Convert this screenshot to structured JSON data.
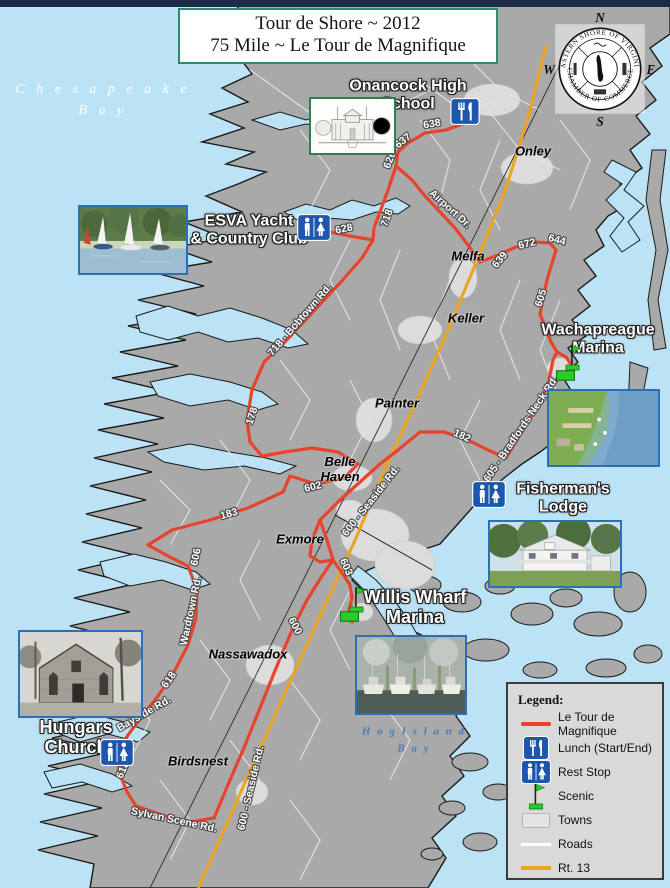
{
  "header": {
    "title_line1": "Tour de Shore ~ 2012",
    "title_line2": "75 Mile ~ Le Tour de Magnifique"
  },
  "logo": {
    "arc_top": "EASTERN SHORE OF VIRGINIA",
    "arc_bottom": "CHAMBER OF COMMERCE",
    "compass_n": "N",
    "compass_w": "W",
    "compass_e": "E",
    "compass_s": "S"
  },
  "water_labels": [
    {
      "id": "chesapeake-bay",
      "cls": "bay-white",
      "x": 103,
      "y": 100,
      "lines": [
        "C h e s a p e a k e",
        "B a y"
      ]
    },
    {
      "id": "hog-island-bay",
      "cls": "bay-blue",
      "x": 414,
      "y": 740,
      "lines": [
        "H o g   I s l a n d",
        "B a y"
      ]
    }
  ],
  "towns": [
    {
      "name": "Onley",
      "x": 533,
      "y": 152
    },
    {
      "name": "Melfa",
      "x": 468,
      "y": 257
    },
    {
      "name": "Keller",
      "x": 466,
      "y": 319
    },
    {
      "name": "Painter",
      "x": 397,
      "y": 404
    },
    {
      "name": "Belle\nHaven",
      "x": 340,
      "y": 470
    },
    {
      "name": "Exmore",
      "x": 300,
      "y": 540
    },
    {
      "name": "Nassawadox",
      "x": 248,
      "y": 655
    },
    {
      "name": "Birdsnest",
      "x": 198,
      "y": 762
    }
  ],
  "road_labels": [
    {
      "t": "638",
      "x": 432,
      "y": 124,
      "r": -10
    },
    {
      "t": "637",
      "x": 403,
      "y": 141,
      "r": -38
    },
    {
      "t": "626",
      "x": 390,
      "y": 160,
      "r": -68
    },
    {
      "t": "Airport Dr.",
      "x": 450,
      "y": 209,
      "r": 42
    },
    {
      "t": "718",
      "x": 387,
      "y": 218,
      "r": -70
    },
    {
      "t": "628",
      "x": 344,
      "y": 229,
      "r": -12
    },
    {
      "t": "639",
      "x": 500,
      "y": 260,
      "r": -50
    },
    {
      "t": "672",
      "x": 527,
      "y": 244,
      "r": -14
    },
    {
      "t": "644",
      "x": 557,
      "y": 240,
      "r": 14
    },
    {
      "t": "605",
      "x": 541,
      "y": 298,
      "r": -72
    },
    {
      "t": "718 - Bobtown Rd.",
      "x": 300,
      "y": 320,
      "r": -49
    },
    {
      "t": "178",
      "x": 252,
      "y": 416,
      "r": -72
    },
    {
      "t": "605 - Bradfords Neck Rd.",
      "x": 521,
      "y": 429,
      "r": -56
    },
    {
      "t": "182",
      "x": 462,
      "y": 436,
      "r": 24
    },
    {
      "t": "602",
      "x": 313,
      "y": 487,
      "r": -14
    },
    {
      "t": "183",
      "x": 229,
      "y": 514,
      "r": -16
    },
    {
      "t": "600 - Seaside Rd.",
      "x": 371,
      "y": 501,
      "r": -52
    },
    {
      "t": "606",
      "x": 196,
      "y": 557,
      "r": -78
    },
    {
      "t": "Wardtown Rd.",
      "x": 191,
      "y": 611,
      "r": -78
    },
    {
      "t": "603",
      "x": 346,
      "y": 567,
      "r": 66
    },
    {
      "t": "600",
      "x": 295,
      "y": 626,
      "r": 62
    },
    {
      "t": "618",
      "x": 169,
      "y": 680,
      "r": -55
    },
    {
      "t": "Bayside Rd.",
      "x": 144,
      "y": 714,
      "r": -30
    },
    {
      "t": "618",
      "x": 123,
      "y": 770,
      "r": -66
    },
    {
      "t": "600 - Seaside Rd.",
      "x": 251,
      "y": 788,
      "r": -77
    },
    {
      "t": "Sylvan Scene Rd.",
      "x": 174,
      "y": 820,
      "r": 12
    }
  ],
  "landmarks": [
    {
      "id": "onancock-high-school",
      "lines": [
        "Onancock High",
        "School"
      ],
      "x": 408,
      "y": 95,
      "fs": 16
    },
    {
      "id": "esva-yacht-country-club",
      "lines": [
        "ESVA Yacht",
        "& Country Club"
      ],
      "x": 249,
      "y": 230,
      "fs": 16
    },
    {
      "id": "wachapreague-marina",
      "lines": [
        "Wachapreague",
        "Marina"
      ],
      "x": 598,
      "y": 339,
      "fs": 16
    },
    {
      "id": "fishermans-lodge",
      "lines": [
        "Fisherman's",
        "Lodge"
      ],
      "x": 563,
      "y": 498,
      "fs": 16
    },
    {
      "id": "willis-wharf-marina",
      "lines": [
        "Willis Wharf",
        "Marina"
      ],
      "x": 415,
      "y": 608,
      "fs": 18
    },
    {
      "id": "hungars-church",
      "lines": [
        "Hungars",
        "Church"
      ],
      "x": 76,
      "y": 738,
      "fs": 18
    }
  ],
  "map_icons": [
    {
      "type": "lunch",
      "x": 450,
      "y": 98,
      "w": 30,
      "h": 27,
      "name": "lunch-icon-onancock"
    },
    {
      "type": "rest",
      "x": 297,
      "y": 214,
      "w": 34,
      "h": 27,
      "name": "restroom-icon-esva"
    },
    {
      "type": "rest",
      "x": 472,
      "y": 481,
      "w": 34,
      "h": 27,
      "name": "restroom-icon-fishermans"
    },
    {
      "type": "rest",
      "x": 100,
      "y": 739,
      "w": 34,
      "h": 27,
      "name": "restroom-icon-hungars"
    },
    {
      "type": "flag",
      "x": 562,
      "y": 343,
      "w": 21,
      "h": 28,
      "name": "scenic-flag-wachapreague"
    },
    {
      "type": "marker",
      "x": 556,
      "y": 370,
      "w": 19,
      "h": 11,
      "name": "scenic-marker-wachapreague"
    },
    {
      "type": "flag",
      "x": 346,
      "y": 585,
      "w": 21,
      "h": 28,
      "name": "scenic-flag-willis-wharf"
    },
    {
      "type": "marker",
      "x": 340,
      "y": 611,
      "w": 19,
      "h": 11,
      "name": "scenic-marker-willis-wharf"
    }
  ],
  "photos": [
    {
      "id": "photo-onancock-school-sketch",
      "x": 309,
      "y": 97,
      "w": 87,
      "h": 58,
      "style": "sketch",
      "border": "#2e7d4f"
    },
    {
      "id": "photo-sailboats",
      "x": 78,
      "y": 205,
      "w": 110,
      "h": 70,
      "style": "sailboats",
      "border": "#2a6fb8"
    },
    {
      "id": "photo-wachapreague-aerial",
      "x": 547,
      "y": 389,
      "w": 113,
      "h": 78,
      "style": "aerial",
      "border": "#2a6fb8"
    },
    {
      "id": "photo-fishermans-lodge",
      "x": 488,
      "y": 520,
      "w": 134,
      "h": 68,
      "style": "lodge",
      "border": "#2a6fb8"
    },
    {
      "id": "photo-willis-wharf-boats",
      "x": 355,
      "y": 635,
      "w": 112,
      "h": 80,
      "style": "boats",
      "border": "#2a6fb8"
    },
    {
      "id": "photo-hungars-church",
      "x": 18,
      "y": 630,
      "w": 125,
      "h": 88,
      "style": "church",
      "border": "#2a6fb8"
    }
  ],
  "legend": {
    "title": "Legend:",
    "items": [
      {
        "icon": "route",
        "label": "Le Tour de Magnifique"
      },
      {
        "icon": "lunch",
        "label": "Lunch (Start/End)"
      },
      {
        "icon": "rest",
        "label": "Rest Stop"
      },
      {
        "icon": "flag",
        "label": "Scenic"
      },
      {
        "icon": "town",
        "label": "Towns"
      },
      {
        "icon": "road",
        "label": "Roads"
      },
      {
        "icon": "rt13",
        "label": "Rt. 13"
      }
    ]
  },
  "colors": {
    "route": "#e8432c",
    "rt13": "#eaa41e",
    "water": "#bce3f5",
    "land": "#a9a9a9",
    "towns": "#dcdcdc",
    "icon_blue": "#1d56ad",
    "scenic": "#29cc29"
  }
}
